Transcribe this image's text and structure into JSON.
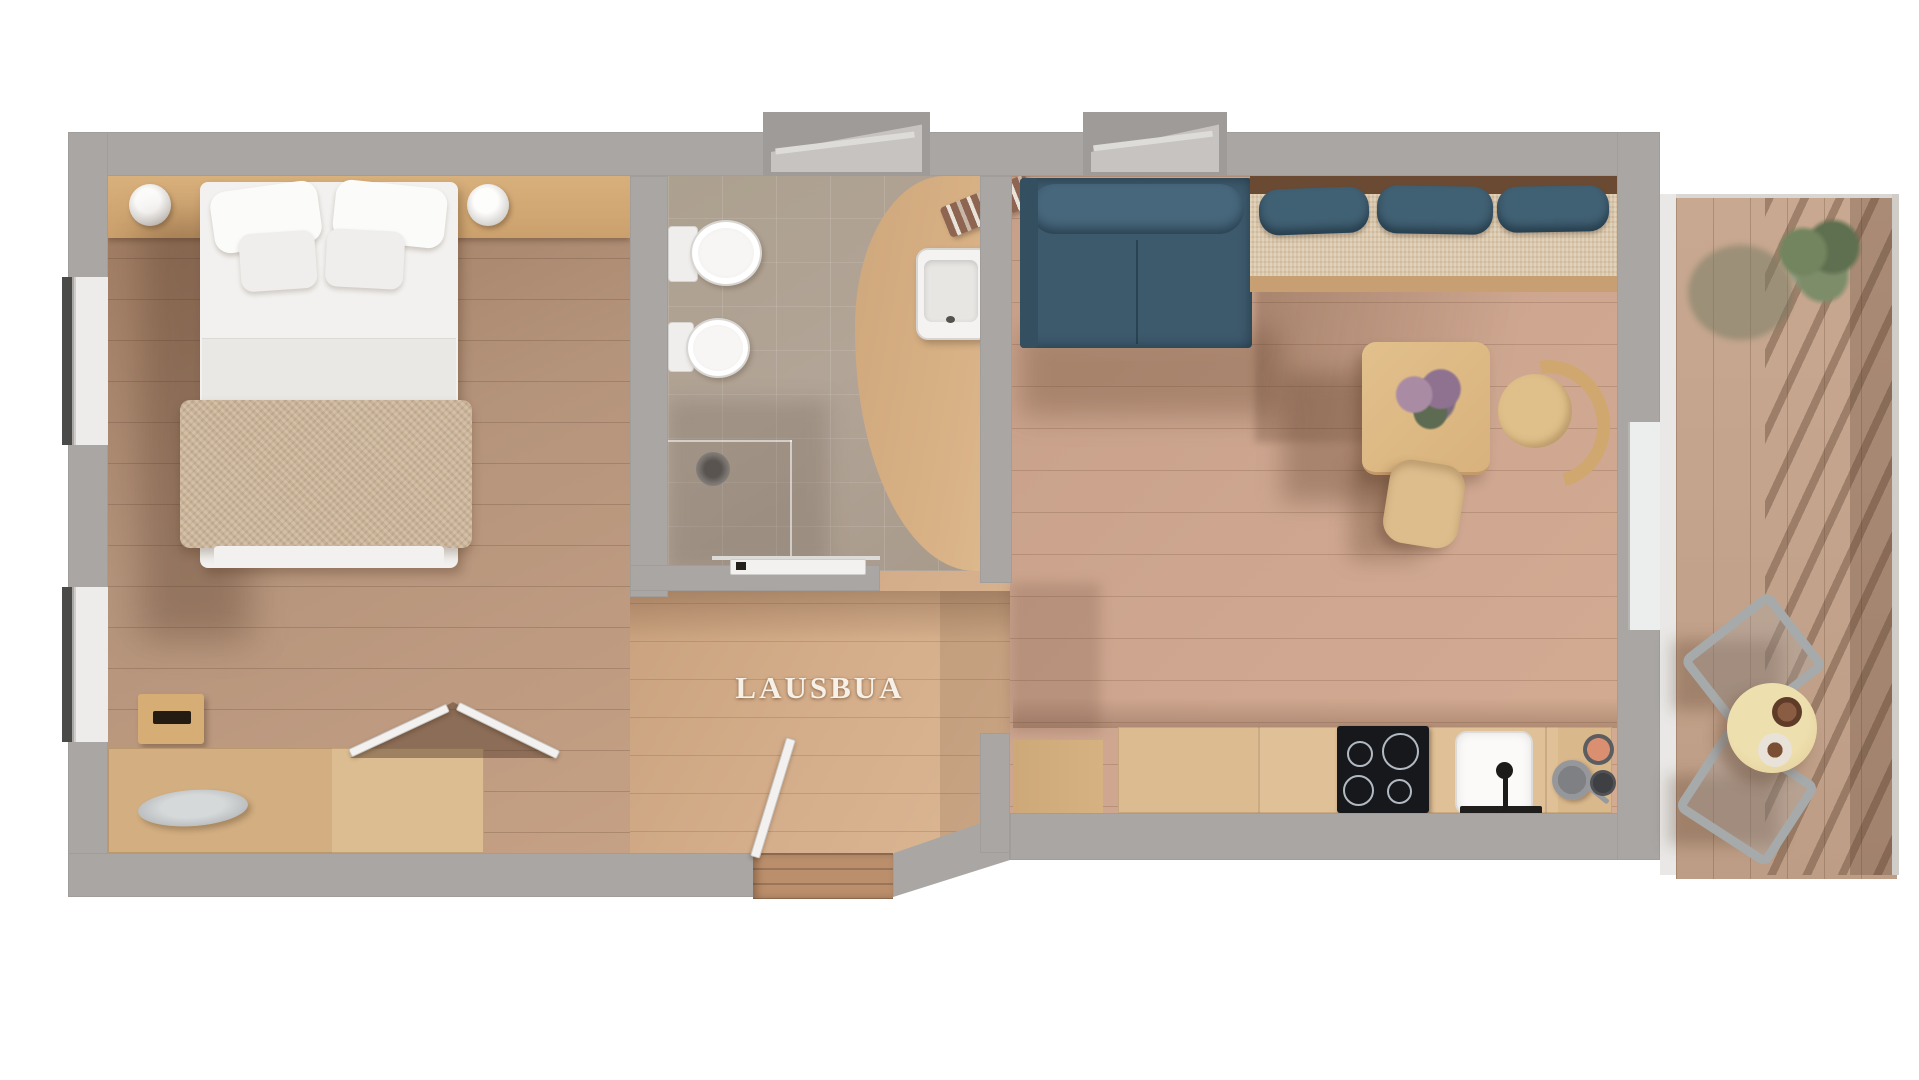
{
  "plan": {
    "label": "LAUSBUA"
  },
  "rooms": [
    {
      "id": "bedroom",
      "furniture": [
        "double-bed",
        "pillows",
        "bed-throw",
        "bedside-lamp-left",
        "bedside-lamp-right",
        "storage-box",
        "sideboard-desk",
        "decor-plate",
        "double-door"
      ]
    },
    {
      "id": "bathroom",
      "furniture": [
        "toilet",
        "bidet",
        "shower-drain",
        "washbasin",
        "towel",
        "sliding-door"
      ]
    },
    {
      "id": "hallway",
      "furniture": [
        "entrance-door",
        "entry-steps"
      ]
    },
    {
      "id": "living-room",
      "furniture": [
        "sofa",
        "corner-bench",
        "bench-pillows",
        "dining-table",
        "table-plant",
        "dining-chair-right",
        "dining-chair-front"
      ]
    },
    {
      "id": "kitchen",
      "furniture": [
        "kitchen-counter",
        "induction-hob",
        "kitchen-sink",
        "faucet",
        "cooking-pots"
      ]
    },
    {
      "id": "balcony",
      "furniture": [
        "outdoor-table",
        "serving-bowls",
        "outdoor-chair-upper",
        "outdoor-chair-lower",
        "potted-plant",
        "railing"
      ]
    }
  ],
  "palette": {
    "wall": "#a9a6a3",
    "wall_light": "#c6c3c0",
    "bedroom_floor": "#b5947c",
    "corridor_floor": "#d4ad8a",
    "living_floor": "#cfa791",
    "bath_tile": "#b2a496",
    "bath_wood": "#d7b084",
    "balcony_deck": "#c3a38b",
    "headboard_wood": "#d0a673",
    "sofa_blue": "#3d5a6c",
    "cushion_blue": "#406073",
    "bench_seat": "#d9c6a9",
    "bench_front": "#c89f72",
    "counter_wood": "#e0c096",
    "hob_black": "#17181c",
    "bed_white": "#f2f1ef",
    "throw_beige": "#c9b296",
    "table_wood": "#deba84",
    "outdoor_table": "#e9d7a2",
    "desk_wood": "#dcbd92",
    "vestibule_wood": "#bb8f6c"
  }
}
